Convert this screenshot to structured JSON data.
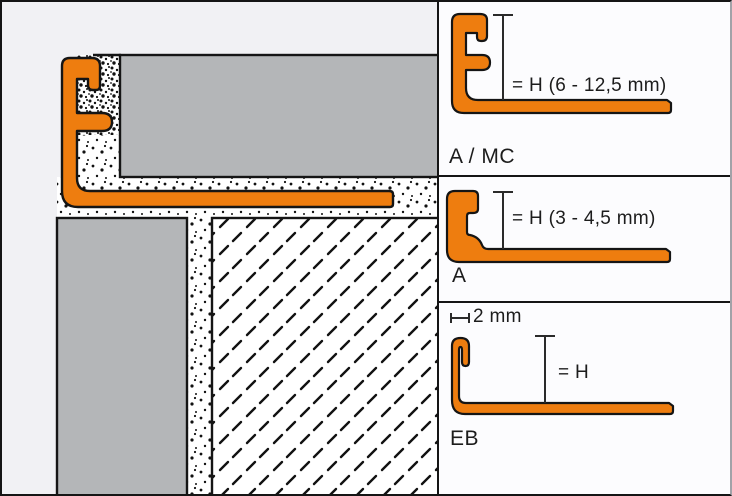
{
  "colors": {
    "orange": "#ee7d0f",
    "tile_gray": "#b4b6b8",
    "outline": "#151515"
  },
  "panels": [
    {
      "name_label": "A / MC",
      "dimension_label": "= H (6 - 12,5 mm)"
    },
    {
      "name_label": "A",
      "dimension_label": "= H (3 - 4,5 mm)"
    },
    {
      "name_label": "EB",
      "dimension_label": "= H",
      "width_label": "2 mm"
    }
  ]
}
